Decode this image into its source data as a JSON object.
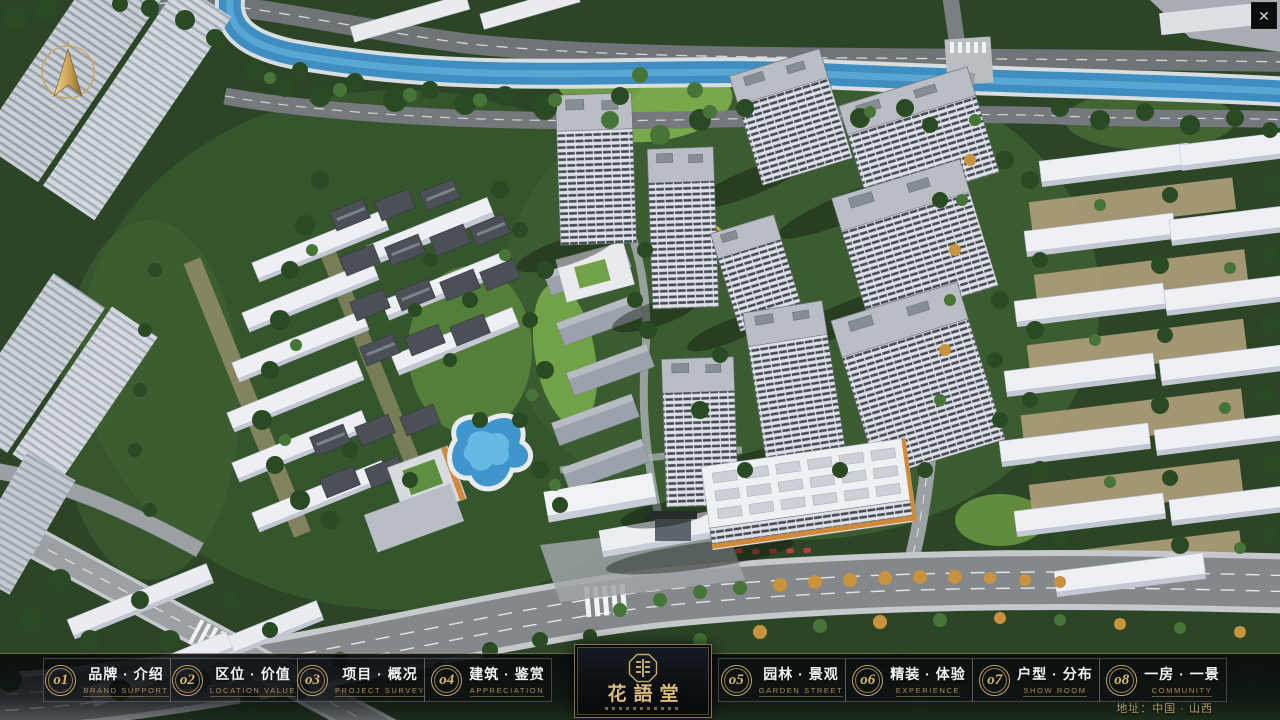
{
  "window": {
    "close_icon": "✕"
  },
  "compass": {
    "icon": "north-arrow"
  },
  "nav": {
    "items": [
      {
        "number": "o1",
        "title": "品牌 · 介绍",
        "subtitle": "BRAND SUPPORT"
      },
      {
        "number": "o2",
        "title": "区位 · 价值",
        "subtitle": "LOCATION VALUE"
      },
      {
        "number": "o3",
        "title": "项目 · 概况",
        "subtitle": "PROJECT SURVEY"
      },
      {
        "number": "o4",
        "title": "建筑 · 鉴赏",
        "subtitle": "APPRECIATION"
      },
      {
        "number": "o5",
        "title": "园林 · 景观",
        "subtitle": "GARDEN STREET"
      },
      {
        "number": "o6",
        "title": "精装 · 体验",
        "subtitle": "EXPERIENCE"
      },
      {
        "number": "o7",
        "title": "户型 · 分布",
        "subtitle": "SHOW ROOM"
      },
      {
        "number": "o8",
        "title": "一房 · 一景",
        "subtitle": "COMMUNITY"
      }
    ]
  },
  "logo": {
    "name": "花語堂"
  },
  "footer": {
    "address": "地址：中国 · 山西"
  },
  "palette": {
    "accent_gold": "#c9a96a",
    "subtitle_gold": "#ab8d55",
    "logo_text_gold": "#dcbc7c",
    "navbar_bg": "#0a0d0f",
    "river_blue": "#3e8ec2",
    "grass_green": "#79a84b",
    "tree_green": "#2e5128",
    "building_white": "#eef0f4",
    "trim_orange": "#d18a38",
    "accent_red": "#b8403a"
  }
}
